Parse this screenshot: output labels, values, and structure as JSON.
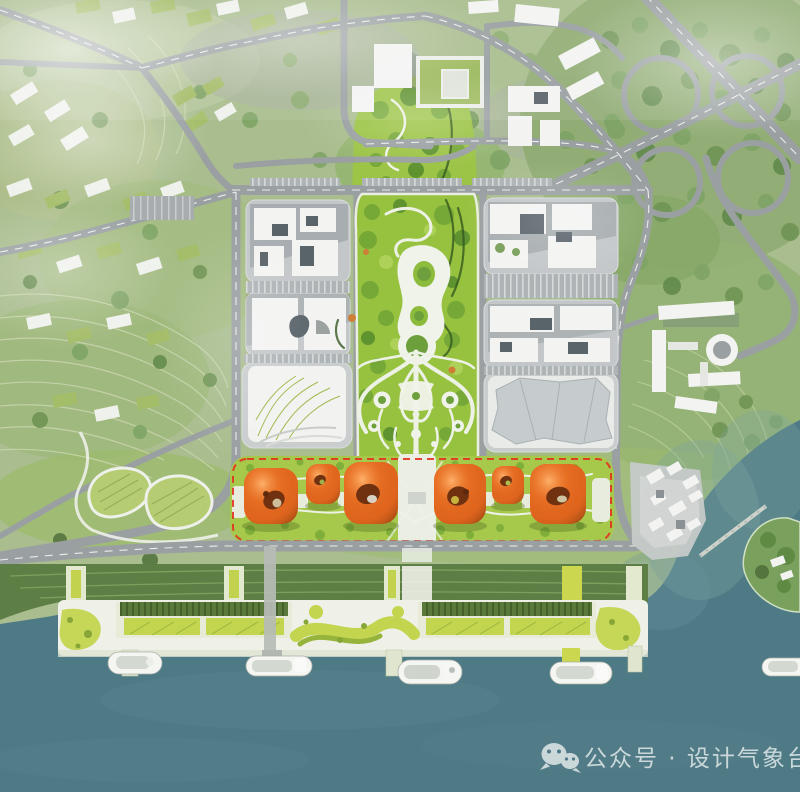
{
  "meta": {
    "type": "aerial-architectural-rendering",
    "subject": "Bird's-eye masterplan rendering: waterfront district with orange pavilions, central linear park, ferry piers and river"
  },
  "watermark": {
    "icon": "wechat-icon",
    "text": "公众号 · 设计气象台"
  },
  "palette": {
    "terrain": "#a9bd8e",
    "forest_green": "#7ba161",
    "park_green": "#97c23f",
    "park_green_light": "#9cc446",
    "strip_green": "#a6c94c",
    "deck_green": "#c3d44e",
    "embankment_green": "#5d7f45",
    "water": "#4e7a86",
    "water_shallow": "#7fa79e",
    "road_gray": "#9aa0a2",
    "plaza_gray": "#c3c7c9",
    "building_white": "#f3f4f2",
    "building_dark": "#59636a",
    "pavilion_orange": "#e2671e",
    "pavilion_hole": "#6f3110",
    "boundary_red": "#e23222",
    "deck_white": "#eff1e8",
    "boat_white": "#f5f6f2",
    "island_green": "#7aa05e",
    "watermark_color": "#e0e9e9"
  },
  "scene": {
    "regions": [
      {
        "name": "hillside-residential",
        "desc": "terraced green hillside with small housing blocks, upper left"
      },
      {
        "name": "cloverleaf-interchange",
        "desc": "highway cloverleaf interchange in woodland, upper right"
      },
      {
        "name": "office-blocks-west",
        "desc": "white building cluster on gray podium west of the park"
      },
      {
        "name": "office-blocks-east",
        "desc": "white building cluster on gray podium east of the park"
      },
      {
        "name": "central-park",
        "desc": "linear green park with organic white paths and round clearings"
      },
      {
        "name": "orange-pavilions",
        "desc": "six rounded orange pavilions on a green band inside a red dashed site boundary"
      },
      {
        "name": "waterfront-promenade",
        "desc": "white deck with chartreuse planting, green-roof halls and ferry piers"
      },
      {
        "name": "river",
        "desc": "teal water with ferries, a small green island and a footbridge"
      }
    ],
    "counts": {
      "orange_pavilions": 6,
      "ferries": 5
    }
  }
}
